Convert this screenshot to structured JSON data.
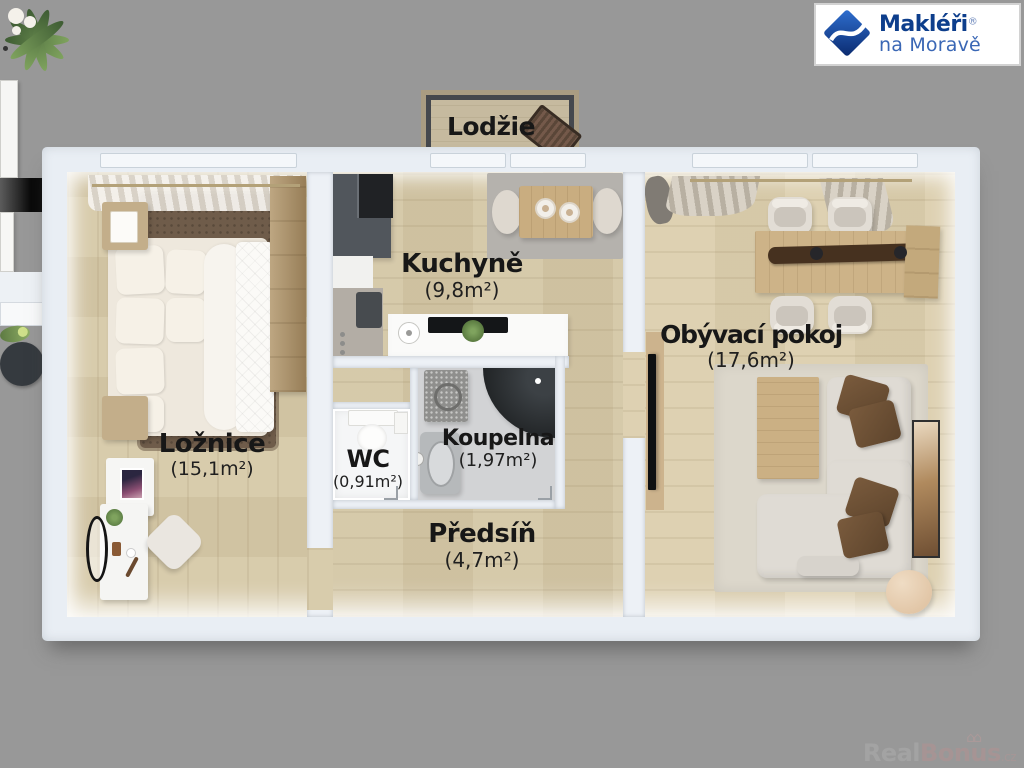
{
  "page": {
    "background_color": "#989898",
    "type": "apartment-floor-plan-render"
  },
  "logo": {
    "brand_line1": "Makléři",
    "registered_mark": "®",
    "brand_line2": "na Moravě",
    "icon": "diamond-swoosh-logo",
    "primary_color": "#0d3e8c",
    "secondary_color": "#3a67b5"
  },
  "watermark": {
    "part_real": "Real",
    "part_bonus": "Bonus",
    "part_cz": ".cz",
    "icon": "houses-icon"
  },
  "rooms": {
    "lodzie": {
      "name": "Lodžie",
      "area": ""
    },
    "kuchyne": {
      "name": "Kuchyně",
      "area": "(9,8m²)"
    },
    "obyvaci_pokoj": {
      "name": "Obývací pokoj",
      "area": "(17,6m²)"
    },
    "loznice": {
      "name": "Ložnice",
      "area": "(15,1m²)"
    },
    "wc": {
      "name": "WC",
      "area": "(0,91m²)"
    },
    "koupelna": {
      "name": "Koupelna",
      "area": "(1,97m²)"
    },
    "predsin": {
      "name": "Předsíň",
      "area": "(4,7m²)"
    }
  },
  "colors": {
    "background": "#989898",
    "wall": "#e9eef4",
    "floor_wood": "#d6c9a8",
    "floor_living_wood": "#dccfae",
    "bathroom_tile": "#d2d3d5",
    "label_text": "#171717",
    "rug_brown": "#6f5c4a",
    "rug_gray": "#b5b2ad",
    "rug_beige": "#dcd7cb",
    "sofa_cream": "#dfdbd4",
    "pillow_brown": "#6d5137",
    "kitchen_dark_unit": "#51565c",
    "shower_dark": "#222527",
    "logo_blue": "#0d3e8c"
  }
}
